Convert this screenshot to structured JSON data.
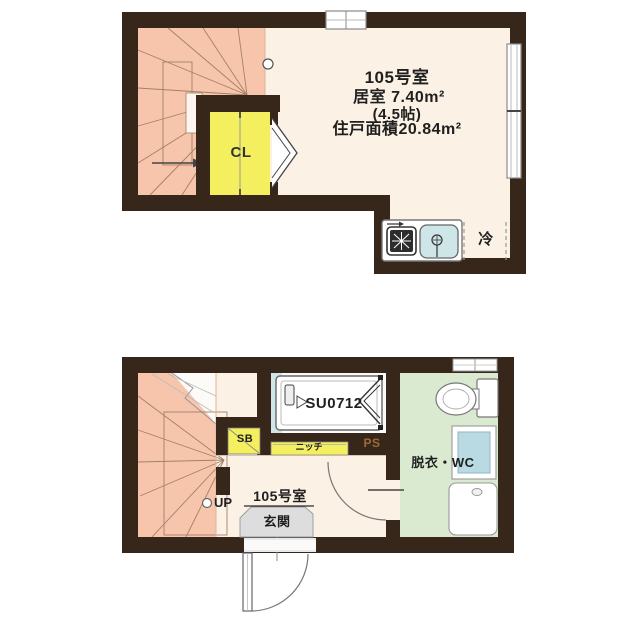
{
  "colors": {
    "wall": "#37261a",
    "stairs": "#f6c5ab",
    "room": "#fbf1e4",
    "closet": "#f3ef5e",
    "washroom": "#d9ead1",
    "water": "#cfe6e8",
    "entrance": "#dddddd",
    "ps_text": "#a06a38",
    "text": "#1f1f1f"
  },
  "floor2": {
    "labels": {
      "unit": "105号室",
      "room_area": "居室 7.40m²",
      "tatami": "(4.5帖)",
      "total_area": "住戸面積20.84m²",
      "closet": "CL",
      "refrigerator": "冷"
    }
  },
  "floor1": {
    "labels": {
      "shower_unit": "SU0712",
      "shoe_box": "SB",
      "niche": "ニッチ",
      "pipe_space": "PS",
      "washroom": "脱衣・WC",
      "up": "UP",
      "unit": "105号室",
      "entrance": "玄関"
    }
  }
}
